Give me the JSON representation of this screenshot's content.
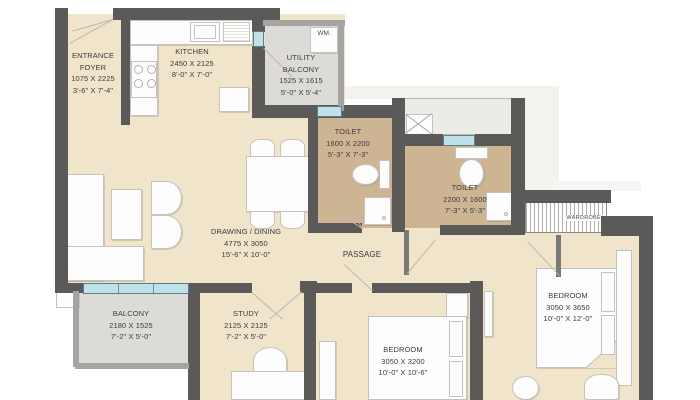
{
  "colors": {
    "wall": "#5c5a58",
    "floor": "#f0e4cb",
    "toilet_floor": "#cdb493",
    "balcony_floor": "#dcdbd8",
    "shaft": "#ecebe7",
    "window": "#bfe2ea",
    "furniture": "#fdfdfd",
    "text": "#3c3c3c"
  },
  "rooms": {
    "entrance_foyer": {
      "name": "ENTRANCE",
      "name2": "FOYER",
      "size_mm": "1075 X 2225",
      "size_ft": "3'-6\" X 7'-4\""
    },
    "kitchen": {
      "name": "KITCHEN",
      "size_mm": "2450 X 2125",
      "size_ft": "8'-0\" X 7'-0\""
    },
    "utility_balcony": {
      "name": "UTILITY",
      "name2": "BALCONY",
      "size_mm": "1525 X 1615",
      "size_ft": "5'-0\" X 5'-4\""
    },
    "toilet_1": {
      "name": "TOILET",
      "size_mm": "1600 X 2200",
      "size_ft": "5'-3\" X 7'-3\""
    },
    "toilet_2": {
      "name": "TOILET",
      "size_mm": "2200 X 1600",
      "size_ft": "7'-3\" X 5'-3\""
    },
    "drawing_dining": {
      "name": "DRAWING / DINING",
      "size_mm": "4775 X 3050",
      "size_ft": "15'-6\" X 10'-0\""
    },
    "passage": {
      "name": "PASSAGE"
    },
    "balcony": {
      "name": "BALCONY",
      "size_mm": "2180 X 1525",
      "size_ft": "7'-2\" X 5'-0\""
    },
    "study": {
      "name": "STUDY",
      "size_mm": "2125 X 2125",
      "size_ft": "7'-2\" X 5'-0\""
    },
    "bedroom_1": {
      "name": "BEDROOM",
      "size_mm": "3050 X 3200",
      "size_ft": "10'-0\" X 10'-6\""
    },
    "bedroom_2": {
      "name": "BEDROOM",
      "size_mm": "3050 X 3650",
      "size_ft": "10'-0\" X 12'-0\""
    }
  },
  "fixtures": {
    "washing_machine": "WM.",
    "wardrobe": "WARDROBE"
  }
}
